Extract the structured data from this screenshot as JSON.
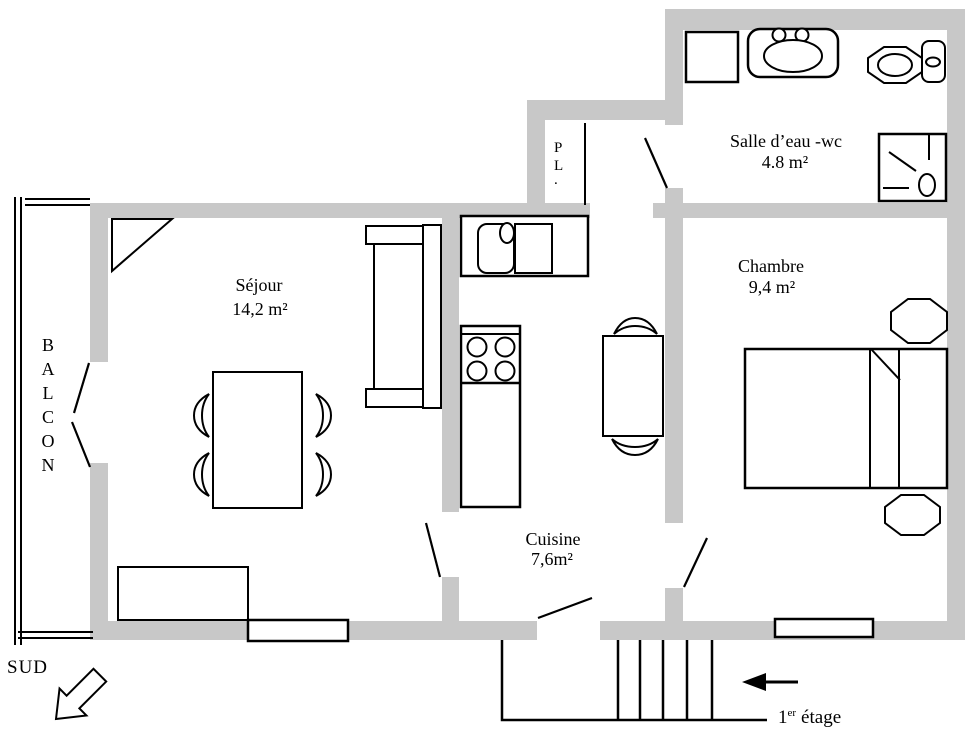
{
  "colors": {
    "wall": "#c8c8c8",
    "line": "#000000",
    "background": "#ffffff"
  },
  "rooms": {
    "sejour": {
      "name": "Séjour",
      "area": "14,2 m²"
    },
    "cuisine": {
      "name": "Cuisine",
      "area": "7,6m²"
    },
    "chambre": {
      "name": "Chambre",
      "area": "9,4 m²"
    },
    "salle_eau": {
      "name": "Salle d’eau -wc",
      "area": "4.8 m²"
    },
    "placard": {
      "letters": [
        "P",
        "L",
        "."
      ]
    },
    "balcon": {
      "letters": [
        "B",
        "A",
        "L",
        "C",
        "O",
        "N"
      ]
    }
  },
  "compass": {
    "south": "SUD"
  },
  "floor": {
    "number": "1",
    "ordinal": "er",
    "word": "étage"
  }
}
